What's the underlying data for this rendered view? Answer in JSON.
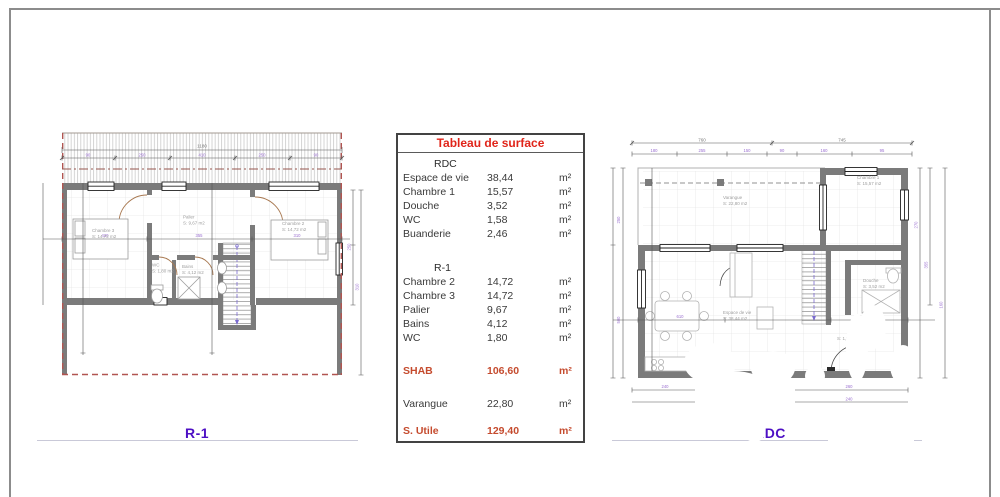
{
  "surface_table": {
    "title": "Tableau de surface",
    "unit": "m²",
    "sections": [
      {
        "header": "RDC",
        "rows": [
          {
            "label": "Espace de vie",
            "value": "38,44"
          },
          {
            "label": "Chambre 1",
            "value": "15,57"
          },
          {
            "label": "Douche",
            "value": "3,52"
          },
          {
            "label": "WC",
            "value": "1,58"
          },
          {
            "label": "Buanderie",
            "value": "2,46"
          }
        ]
      },
      {
        "header": "R-1",
        "rows": [
          {
            "label": "Chambre 2",
            "value": "14,72"
          },
          {
            "label": "Chambre 3",
            "value": "14,72"
          },
          {
            "label": "Palier",
            "value": "9,67"
          },
          {
            "label": "Bains",
            "value": "4,12"
          },
          {
            "label": "WC",
            "value": "1,80"
          }
        ]
      }
    ],
    "shab": {
      "label": "SHAB",
      "value": "106,60"
    },
    "varangue_row": {
      "label": "Varangue",
      "value": "22,80"
    },
    "utile": {
      "label": "S. Utile",
      "value": "129,40"
    }
  },
  "r1_plan": {
    "label": "R-1",
    "rooms": {
      "chambre3": {
        "name": "Chambre 3",
        "area": "S: 14,72 m2"
      },
      "palier": {
        "name": "Palier",
        "area": "S: 9,67 m2"
      },
      "chambre2": {
        "name": "Chambre 2",
        "area": "S: 14,72 m2"
      },
      "wc": {
        "name": "WC",
        "area": "S: 1,80 m2"
      },
      "bains": {
        "name": "Bains",
        "area": "S: 4,12 m2"
      }
    },
    "dims": {
      "top_total": "1180",
      "top": [
        "90",
        "250",
        "410",
        "250",
        "90"
      ],
      "cross": [
        "420",
        "355",
        "310"
      ],
      "right": [
        "250",
        "310"
      ]
    }
  },
  "rdc_plan": {
    "label": "RDC",
    "rooms": {
      "varangue": {
        "name": "Varangue",
        "area": "S: 22,80 m2"
      },
      "chambre1": {
        "name": "Chambre 1",
        "area": "S: 15,57 m2"
      },
      "espace": {
        "name": "Espace de vie",
        "area": "S: 38,44 m2"
      },
      "douche": {
        "name": "Douche",
        "area": "S: 3,52 m2"
      },
      "wc_area": "S: 1,58 m2"
    },
    "dims": {
      "top_main": [
        "760",
        "745"
      ],
      "top_detail": [
        "180",
        "255",
        "150",
        "90",
        "160",
        "95"
      ],
      "cross": [
        "610",
        "140"
      ],
      "left": [
        "250",
        "500"
      ],
      "right": [
        "270",
        "355",
        "160"
      ],
      "bottom": [
        "240",
        "260",
        "240"
      ]
    }
  },
  "colors": {
    "title_red": "#e0251a",
    "total_red": "#c54b2e",
    "plan_label_purple": "#4d0fc4",
    "wall_gray": "#7b7b7b",
    "roof_dash_red": "#b15551",
    "frame_gray": "#8c8c8c"
  }
}
